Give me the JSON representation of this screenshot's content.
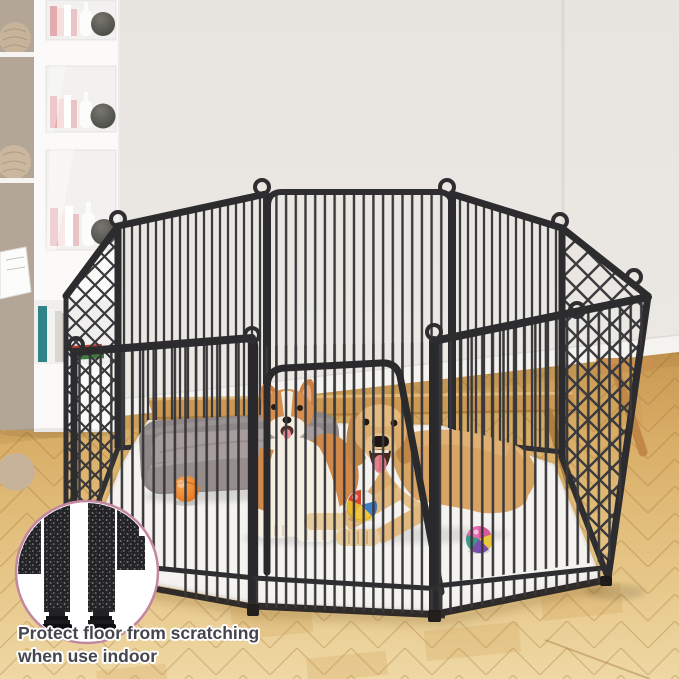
{
  "meta": {
    "type": "product-lifestyle-photo",
    "width_px": 679,
    "height_px": 679
  },
  "caption": {
    "line1": "Protect floor from scratching",
    "line2": "when use indoor"
  },
  "scene": {
    "product": "8-panel heavy-duty metal dog playpen with walk-through door",
    "pen_features": [
      "vertical wire bars",
      "X cross-brace side panels",
      "loop pin connectors",
      "rounded top corners",
      "anti-scratch feet"
    ],
    "animals": [
      {
        "name": "corgi",
        "pose": "lying with mouth open"
      },
      {
        "name": "golden-retriever",
        "pose": "lying with front paws extended, mouth open"
      }
    ],
    "props": [
      "gray pet bed",
      "orange ball",
      "red-yellow-blue toy ball",
      "pink-purple-green toy ball",
      "white floor mat",
      "white bookcase with books and vases",
      "beige knitted vases",
      "light wood bench",
      "herringbone parquet floor"
    ],
    "inset": {
      "shape": "circle",
      "content": "close-up of two panel posts with floor-protecting feet"
    }
  },
  "colors": {
    "pen_frame": "#2e2e31",
    "wall": "#e9e6e2",
    "floor_wood": "#ddb26e",
    "mat": "#f5f3ef",
    "bed": "#8f8787",
    "inset_border": "#c387a0",
    "caption_text": "#45454e",
    "corgi_coat": "#d0884b",
    "retriever_coat": "#d8a464"
  }
}
